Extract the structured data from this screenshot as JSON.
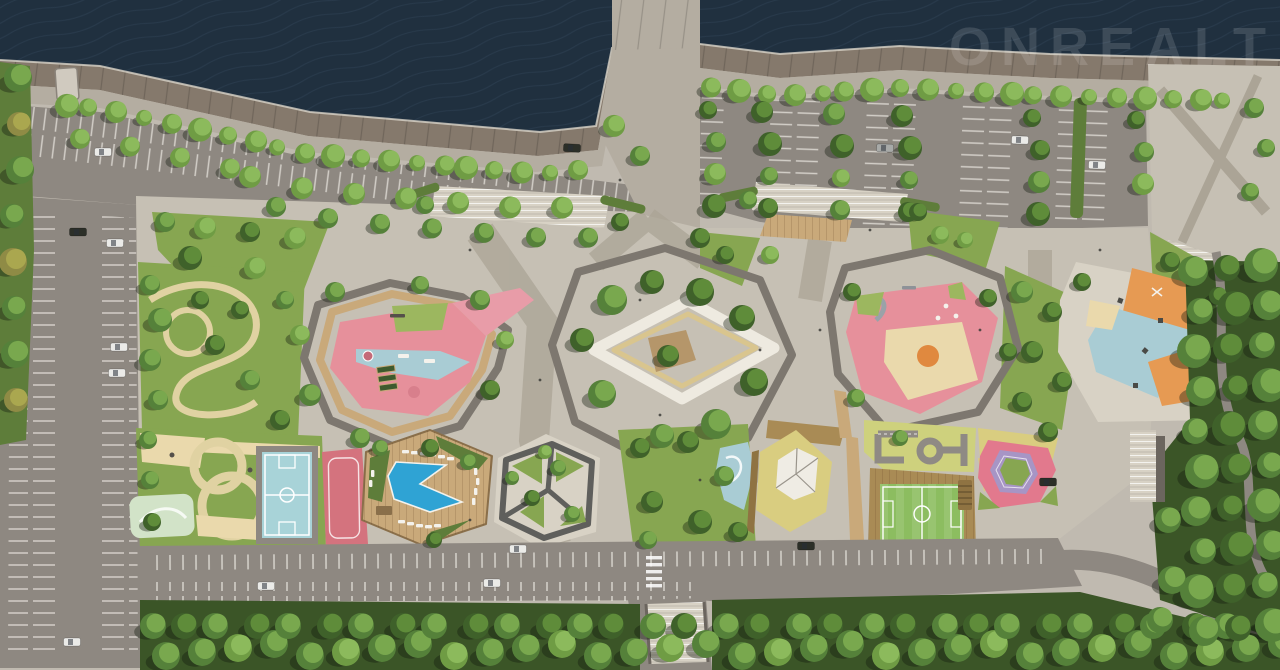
{
  "watermark": {
    "text": "ONREALT",
    "color": "#ffffff",
    "opacity": 0.13
  },
  "colors": {
    "water": "#20303f",
    "waterWave": "#33475c",
    "quayEdge": "#d8d3c8",
    "embankment": "#85796c",
    "walkway": "#b4ada1",
    "concrete": "#c6c0b4",
    "concreteDark": "#aba496",
    "plaza": "#d8d2c5",
    "asphalt": "#8e8881",
    "asphaltDark": "#7f7973",
    "stall": "#e9e6df",
    "lawn": "#87a651",
    "lawnLight": "#9cb75f",
    "lawnDark": "#5e7d3a",
    "foliageBed": "#42602d",
    "forest": "#3b5527",
    "wood": "#c9a97a",
    "woodDark": "#a98b55",
    "fence": "#8f7342",
    "deckCenter": "#b5966a",
    "sand": "#ead9ac",
    "khaki": "#d9cd80",
    "trafficBase": "#ced17d",
    "field": "#8cbd60",
    "pink": "#e6909b",
    "pinkPath": "#e89ca8",
    "pinkCourt": "#d4737e",
    "pinkCourt2": "#e2798d",
    "blue": "#a9ccd4",
    "pool": "#2fa3d4",
    "court": "#a8d3d8",
    "orange": "#e69a53",
    "orangeEq": "#e0893f",
    "purple": "#a795c5",
    "mint": "#d2e3c8",
    "white": "#efece4",
    "loop": "#eeeae0",
    "loopInner": "#d9c58e",
    "pathTan": "#e0d2a2",
    "ringPath": "#7d776f",
    "car": "#ebebe8",
    "carDark": "#2c2f28",
    "carSilver": "#a8aaa8",
    "shadow": "rgba(18,26,12,0.38)"
  }
}
